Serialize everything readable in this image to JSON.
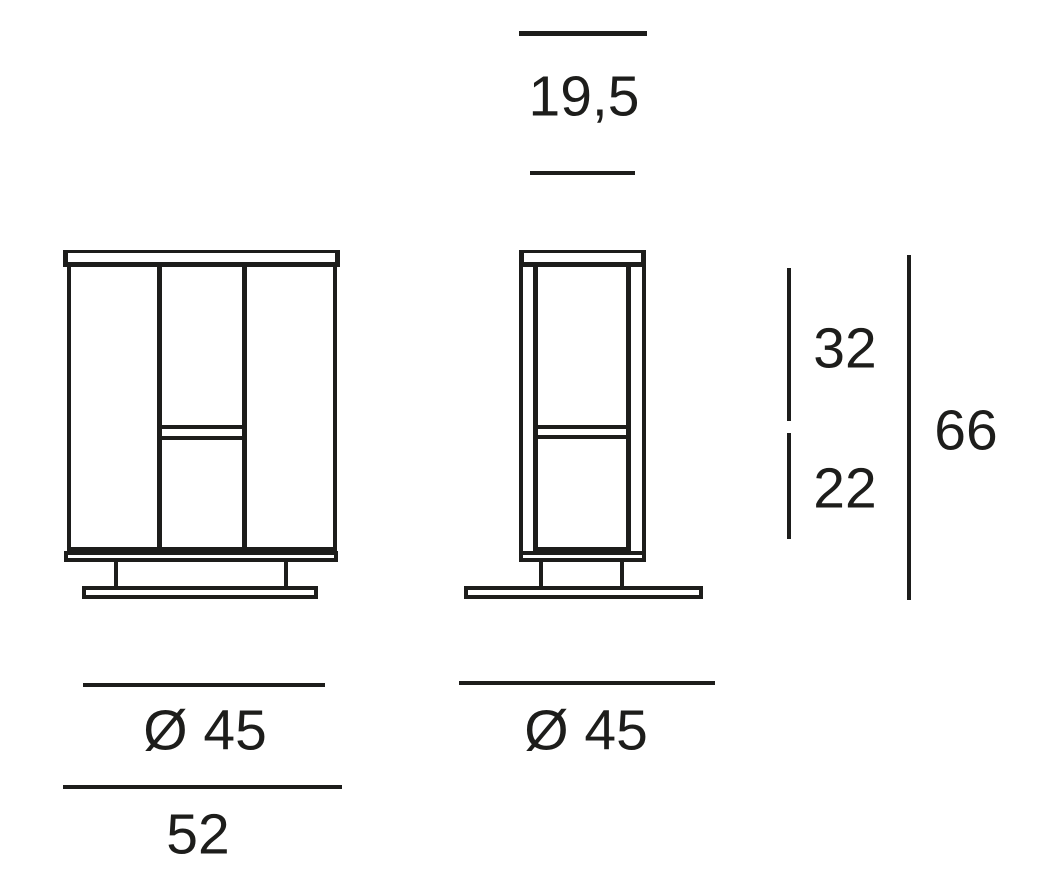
{
  "colors": {
    "line": "#1d1d1b",
    "background": "#ffffff"
  },
  "dimensions": {
    "depth": "19,5",
    "upper_section_height": "32",
    "lower_section_height": "22",
    "total_height": "66",
    "base_diameter_front": "Ø 45",
    "base_diameter_side": "Ø 45",
    "total_width": "52"
  }
}
